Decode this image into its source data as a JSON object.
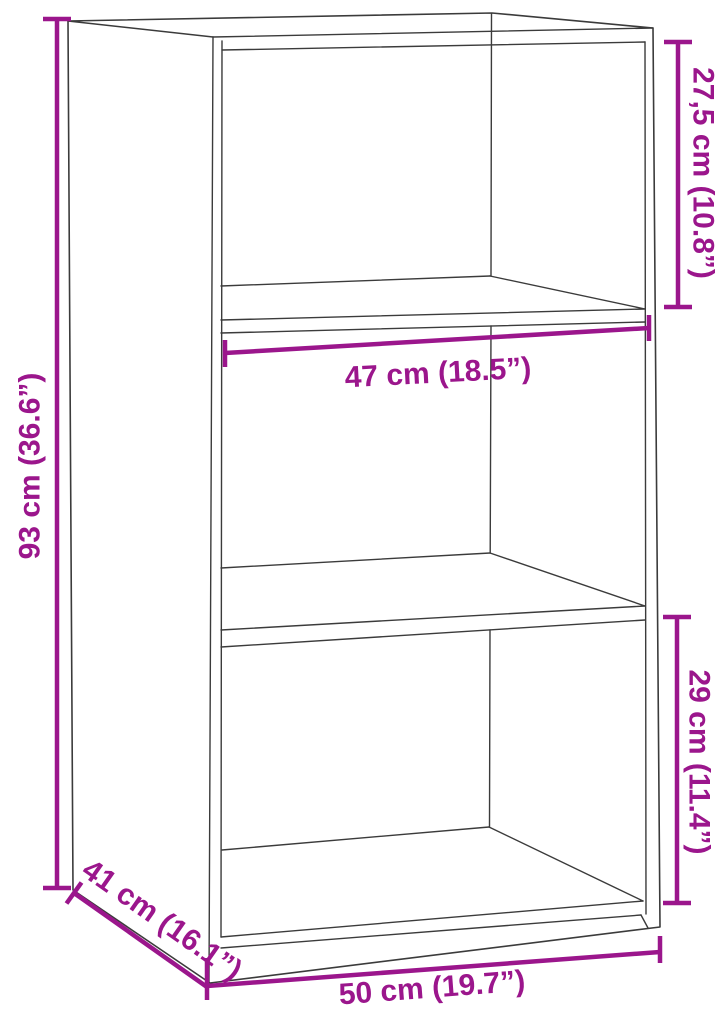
{
  "page": {
    "background_color": "#ffffff",
    "width_px": 724,
    "height_px": 1020
  },
  "diagram": {
    "kind": "product-dimension-line-drawing",
    "subject": "three-shelf cabinet shown in perspective outline",
    "line_color": "#3b3b3b",
    "accent_color": "#9b168c",
    "dimensions": {
      "height": {
        "cm": "93",
        "inches": "36.6",
        "label": "93 cm (36.6”)"
      },
      "top_compartment": {
        "cm": "27,5",
        "inches": "10.8",
        "label": "27,5 cm (10.8”)"
      },
      "inner_width": {
        "cm": "47",
        "inches": "18.5",
        "label": "47 cm (18.5”)"
      },
      "lower_compartment": {
        "cm": "29",
        "inches": "11.4",
        "label": "29 cm (11.4”)"
      },
      "depth": {
        "cm": "41",
        "inches": "16.1",
        "label": "41 cm (16.1”)"
      },
      "width": {
        "cm": "50",
        "inches": "19.7",
        "label": "50 cm (19.7”)"
      }
    }
  }
}
